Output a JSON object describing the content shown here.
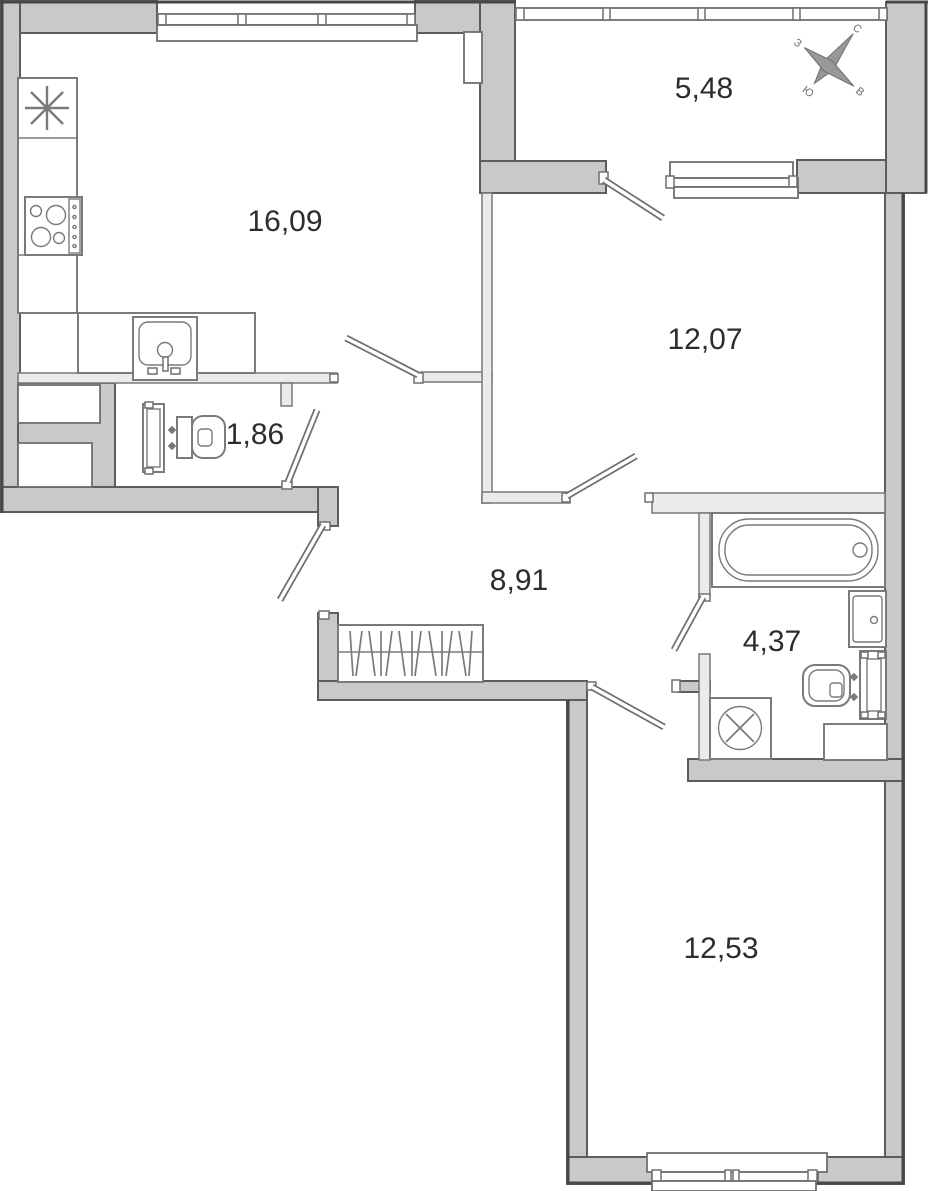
{
  "title": "apartment-floor-plan",
  "rooms": [
    {
      "name": "kitchen-living-room",
      "area": "16,09"
    },
    {
      "name": "loggia",
      "area": "5,48"
    },
    {
      "name": "room-1",
      "area": "12,07"
    },
    {
      "name": "wc",
      "area": "1,86"
    },
    {
      "name": "hallway",
      "area": "8,91"
    },
    {
      "name": "bathroom",
      "area": "4,37"
    },
    {
      "name": "room-2",
      "area": "12,53"
    }
  ],
  "compass": {
    "north": "С",
    "south": "Ю",
    "west": "З",
    "east": "В"
  },
  "fixtures": [
    "ventilation-asterisk",
    "cooktop",
    "kitchen-sink",
    "countertop",
    "toilet",
    "cistern",
    "riser-radiator",
    "bathtub",
    "washbasin",
    "wall-hung-toilet",
    "towel-rail",
    "washing-machine",
    "wardrobe-hangers",
    "duct-shaft",
    "window",
    "door-leaf"
  ],
  "colors": {
    "wall": "#c9c9c9",
    "partition": "#ebebeb",
    "outline": "#5d5d5d",
    "outer_outline": "#474747",
    "fixture_stroke": "#7a7a7a",
    "text": "#2d2d2d",
    "background": "#ffffff"
  }
}
